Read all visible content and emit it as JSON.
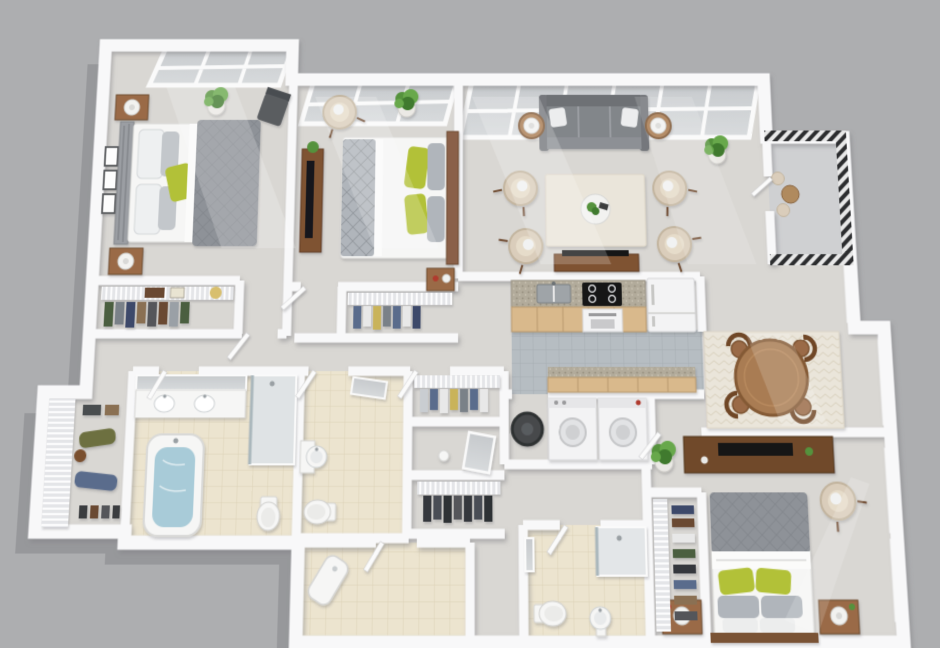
{
  "scene": {
    "title": "3D isometric floor plan render of a three-bedroom apartment",
    "view": "top-down 3D dollhouse render, no text labels",
    "background": "flat gray"
  },
  "palette": {
    "bg": "#adaeb0",
    "shadowC": "#97989b",
    "wall": "#f8f8f9",
    "wallEdge": "#d8d8da",
    "carpet": "#d9d7d3",
    "tileBeige": "#ece4cf",
    "tileGrout": "#dcd2b8",
    "tileGray": "#b6bdc2",
    "tileGrayLine": "#a7aeb3",
    "wood": "#9a6b47",
    "woodDark": "#744c2c",
    "duvet": "#8e9298",
    "duvetLine": "#7c8086",
    "pillowGray": "#b0b5bb",
    "green": "#b2c138",
    "plantGreen": "#55923c",
    "cream": "#dacdbb",
    "sofaGray": "#82868a",
    "white": "#f6f6f5",
    "waterBlue": "#a8cbd8",
    "metalDark": "#2c2d2f",
    "appliance": "#f3f3f4",
    "accentRed": "#b03a2e",
    "granite": "#b2ab9b",
    "cabinetTan": "#d9b98c"
  },
  "rooms": [
    {
      "id": "bedroom-1",
      "label": "Bedroom 1",
      "items": [
        "double bed with gray duvet and green pillow",
        "two nightstands with lamps",
        "three wall art frames",
        "potted plant",
        "dark accent chair",
        "reach-in closet with wire shelf"
      ]
    },
    {
      "id": "bedroom-2",
      "label": "Bedroom 2",
      "items": [
        "double bed with white duvet and green pillows",
        "tv console with tv",
        "cream armchair",
        "potted plants",
        "closet with wire shelf"
      ]
    },
    {
      "id": "living-room",
      "label": "Living Room",
      "items": [
        "gray three-seat sofa",
        "four cream armchairs",
        "two round side tables with lamps",
        "area rug",
        "round coffee table with plant",
        "large potted plant",
        "tv console"
      ]
    },
    {
      "id": "balcony",
      "label": "Balcony",
      "items": [
        "metal railing",
        "bistro table",
        "two chairs"
      ]
    },
    {
      "id": "kitchen",
      "label": "Kitchen",
      "items": [
        "tan cabinets with granite counter",
        "double sink",
        "range with cooktop",
        "refrigerator",
        "lower cabinet run"
      ]
    },
    {
      "id": "dining-room",
      "label": "Dining Room",
      "items": [
        "round wood table",
        "four chairs",
        "patterned rug"
      ]
    },
    {
      "id": "bedroom-3",
      "label": "Bedroom 3",
      "items": [
        "double bed with gray duvet and green pillows",
        "two nightstands with lamps",
        "dresser with tv",
        "cream armchair",
        "potted plant",
        "closet with wire shelving"
      ]
    },
    {
      "id": "bathroom-1",
      "label": "Bathroom 1",
      "items": [
        "bathtub with water",
        "vanity with two sinks and mirror",
        "glass shower",
        "toilet"
      ]
    },
    {
      "id": "bathroom-2",
      "label": "Bathroom 2",
      "items": [
        "pedestal sink",
        "toilet",
        "tilted mirror"
      ]
    },
    {
      "id": "bathroom-3",
      "label": "Bathroom 3",
      "items": [
        "tiled floor",
        "corner fixture"
      ]
    },
    {
      "id": "bathroom-4",
      "label": "Bathroom 4",
      "items": [
        "glass shower",
        "toilet",
        "pedestal sink",
        "mirror"
      ]
    },
    {
      "id": "laundry-utility",
      "label": "Laundry / Utility",
      "items": [
        "water heater",
        "washer",
        "dryer"
      ]
    },
    {
      "id": "walk-in-closet",
      "label": "Walk-in Closet",
      "items": [
        "wire shelving",
        "hanging clothes",
        "shoes"
      ]
    },
    {
      "id": "hallway",
      "label": "Hallways",
      "items": [
        "open doors",
        "carpet"
      ]
    }
  ]
}
